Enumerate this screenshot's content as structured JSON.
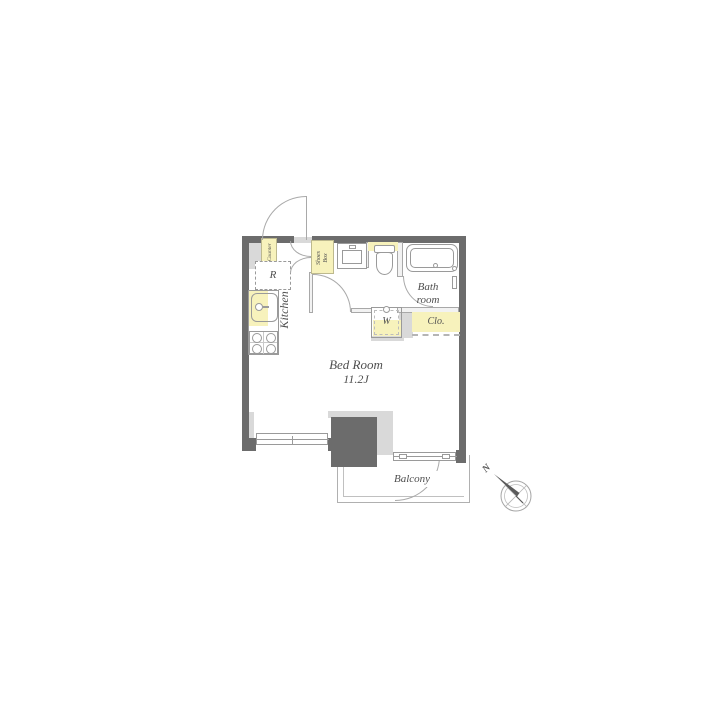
{
  "colors": {
    "wall": "#6c6c6c",
    "light": "#d9d9d9",
    "accent": "#f7f2bc",
    "line": "#9a9a9a",
    "ink": "#4f4f4f"
  },
  "rooms": {
    "bedroom": {
      "name": "Bed Room",
      "size": "11.2J"
    },
    "kitchen": {
      "label": "Kitchen"
    },
    "bath": {
      "line1": "Bath",
      "line2": "room"
    },
    "balcony": {
      "label": "Balcony"
    },
    "closet": {
      "label": "Clo."
    }
  },
  "fixtures": {
    "counter": "Counter",
    "refrigerator": "R",
    "shoes_box_line1": "Shoes",
    "shoes_box_line2": "Box",
    "washer": "W"
  },
  "compass": {
    "north": "N"
  }
}
